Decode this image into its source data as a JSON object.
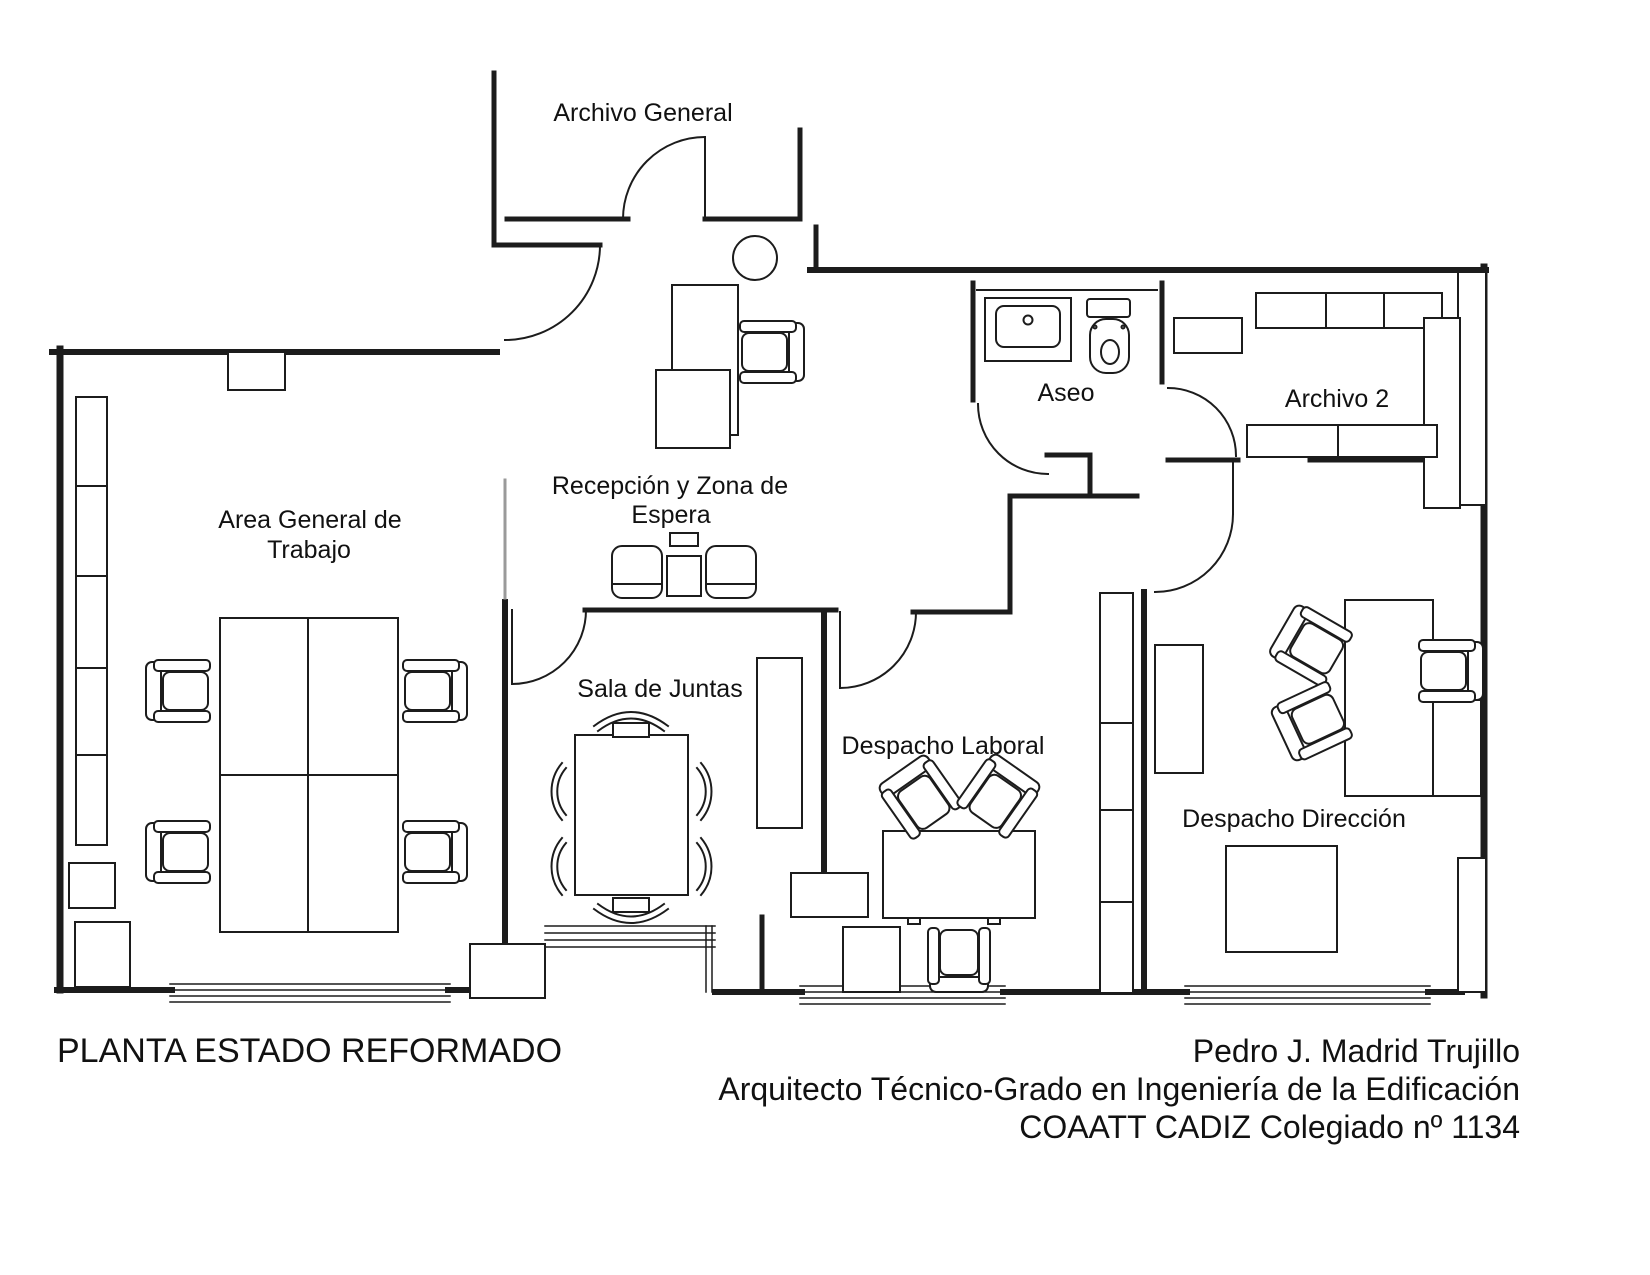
{
  "drawing": {
    "title": "PLANTA ESTADO REFORMADO",
    "credits": {
      "line1": "Pedro J. Madrid Trujillo",
      "line2": "Arquitecto Técnico-Grado en Ingeniería de la Edificación",
      "line3": "COAATT CADIZ Colegiado nº 1134"
    },
    "rooms": {
      "archivo_general": {
        "label": "Archivo General"
      },
      "aseo": {
        "label": "Aseo"
      },
      "archivo_2": {
        "label": "Archivo 2"
      },
      "recepcion": {
        "label_line1": "Recepción y Zona de",
        "label_line2": "Espera"
      },
      "area_general": {
        "label_line1": "Area General de",
        "label_line2": "Trabajo"
      },
      "sala_juntas": {
        "label": "Sala de Juntas"
      },
      "despacho_laboral": {
        "label": "Despacho Laboral"
      },
      "despacho_direccion": {
        "label": "Despacho Dirección"
      }
    },
    "colors": {
      "line": "#1c1c1c",
      "glass": "#9a9a9a",
      "background": "#ffffff"
    }
  }
}
